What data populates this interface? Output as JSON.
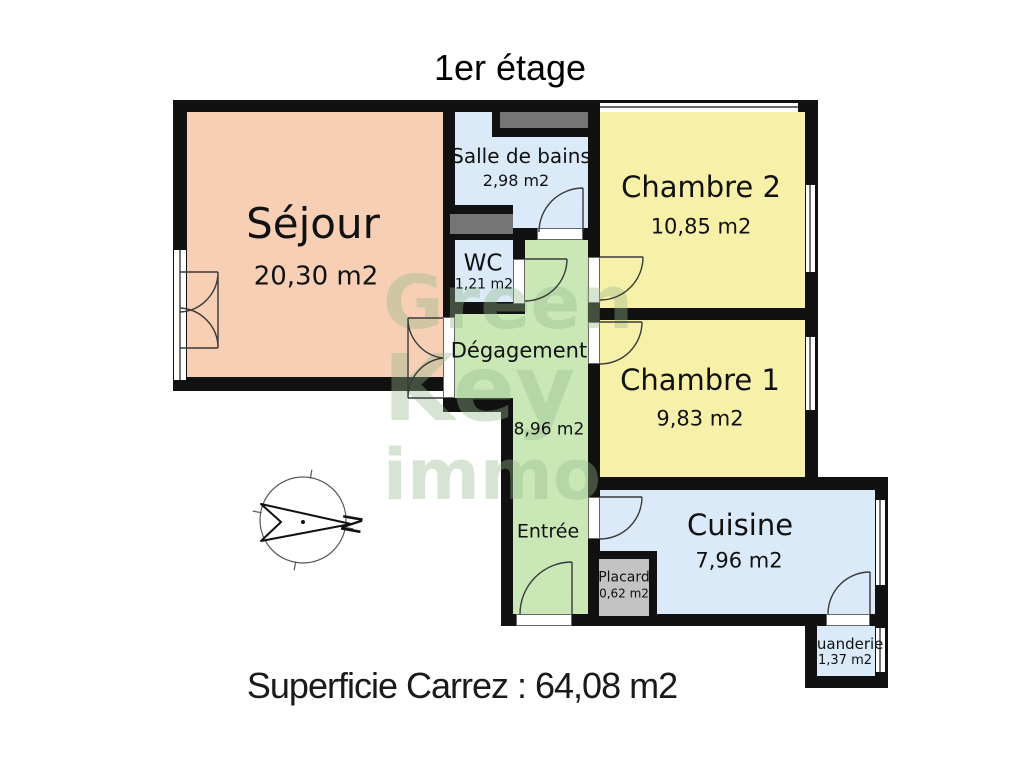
{
  "title": "1er étage",
  "footer": "Superficie Carrez : 64,08 m2",
  "compass": {
    "north_label": "N"
  },
  "watermark": {
    "line1": "Green",
    "line2": "Key",
    "line3": "immo"
  },
  "colors": {
    "wall": "#111111",
    "duct": "#757575",
    "sejour": "#f6cfb4",
    "water_rooms": "#daeaf8",
    "bedrooms": "#f7f0a8",
    "hallway": "#c9e8b6",
    "placard": "#c3c3c3",
    "watermark": "rgba(150,185,140,0.38)"
  },
  "rooms": {
    "sejour": {
      "name": "Séjour",
      "area": "20,30 m2",
      "color": "#f6cfb4"
    },
    "salle_de_bains": {
      "name": "Salle de bains",
      "area": "2,98 m2",
      "color": "#daeaf8"
    },
    "wc": {
      "name": "WC",
      "area": "1,21 m2",
      "color": "#daeaf8"
    },
    "chambre2": {
      "name": "Chambre 2",
      "area": "10,85 m2",
      "color": "#f7f0a8"
    },
    "chambre1": {
      "name": "Chambre 1",
      "area": "9,83 m2",
      "color": "#f7f0a8"
    },
    "degagement": {
      "name": "Dégagement",
      "area": "8,96 m2",
      "color": "#c9e8b6"
    },
    "entree": {
      "name": "Entrée",
      "color": "#c9e8b6"
    },
    "cuisine": {
      "name": "Cuisine",
      "area": "7,96 m2",
      "color": "#daeaf8"
    },
    "placard": {
      "name": "Placard",
      "area": "0,62 m2",
      "color": "#c3c3c3"
    },
    "buanderie": {
      "name": "Buanderie",
      "area": "1,37 m2",
      "color": "#daeaf8"
    }
  }
}
